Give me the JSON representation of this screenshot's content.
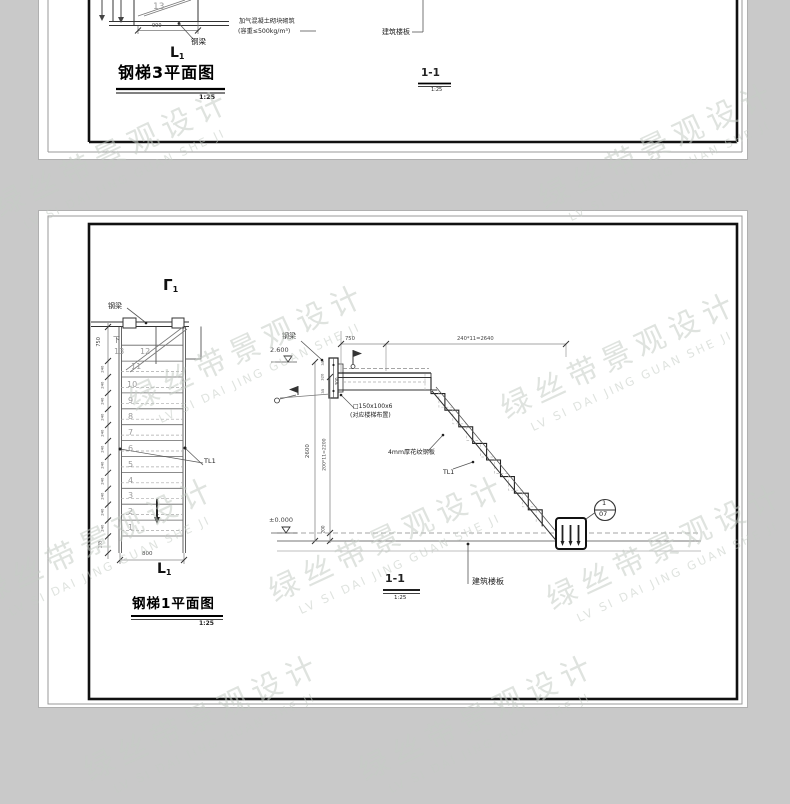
{
  "background_color": "#c9c9c9",
  "watermark": {
    "cn": "绿丝带景观设计",
    "pinyin": "LV SI DAI JING GUAN SHE JI"
  },
  "sheet_top": {
    "step_number": "13",
    "dim_900": "900",
    "label_steel_beam": "钢梁",
    "section_mark": "L",
    "section_mark_sub": "1",
    "title": "钢梯3平面图",
    "title_scale": "1:25",
    "label_aac_line1": "加气混凝土砌块砌筑",
    "label_aac_line2": "(容重≤500kg/m³)",
    "label_floor_slab": "建筑楼板",
    "section_title": "1-1",
    "section_scale": "1:25"
  },
  "sheet_bottom": {
    "plan": {
      "cut_mark_top": "Γ",
      "cut_mark_top_sub": "1",
      "cut_mark_bottom": "L",
      "cut_mark_bottom_sub": "1",
      "label_steel_beam": "钢梁",
      "down_label": "下",
      "step_numbers": [
        "13",
        "12",
        "11",
        "10",
        "9",
        "8",
        "7",
        "6",
        "5",
        "4",
        "3",
        "2",
        "1"
      ],
      "dim_top": "750",
      "dim_tread": "240",
      "dim_bottom": "135",
      "dim_width": "800",
      "label_tl1": "TL1",
      "title": "钢梯1平面图",
      "scale": "1:25"
    },
    "section": {
      "label_steel_beam": "钢梁",
      "elev_top": "2.600",
      "elev_bottom": "±0.000",
      "dim_750": "750",
      "dim_run": "240*11=2640",
      "dim_total_height": "2600",
      "dim_risers": "200*11=2200",
      "dim_200": "200",
      "dim_300": "300",
      "dim_35a": "35",
      "dim_320": "320",
      "dim_35b": "35",
      "label_tube": "□150x100x6",
      "label_tube_note": "(对应楼梯布置)",
      "label_plate": "4mm厚花纹钢板",
      "label_tl1": "TL1",
      "label_slab": "建筑楼板",
      "detail_num": "1",
      "detail_sheet": "07",
      "title": "1-1",
      "scale": "1:25"
    }
  }
}
